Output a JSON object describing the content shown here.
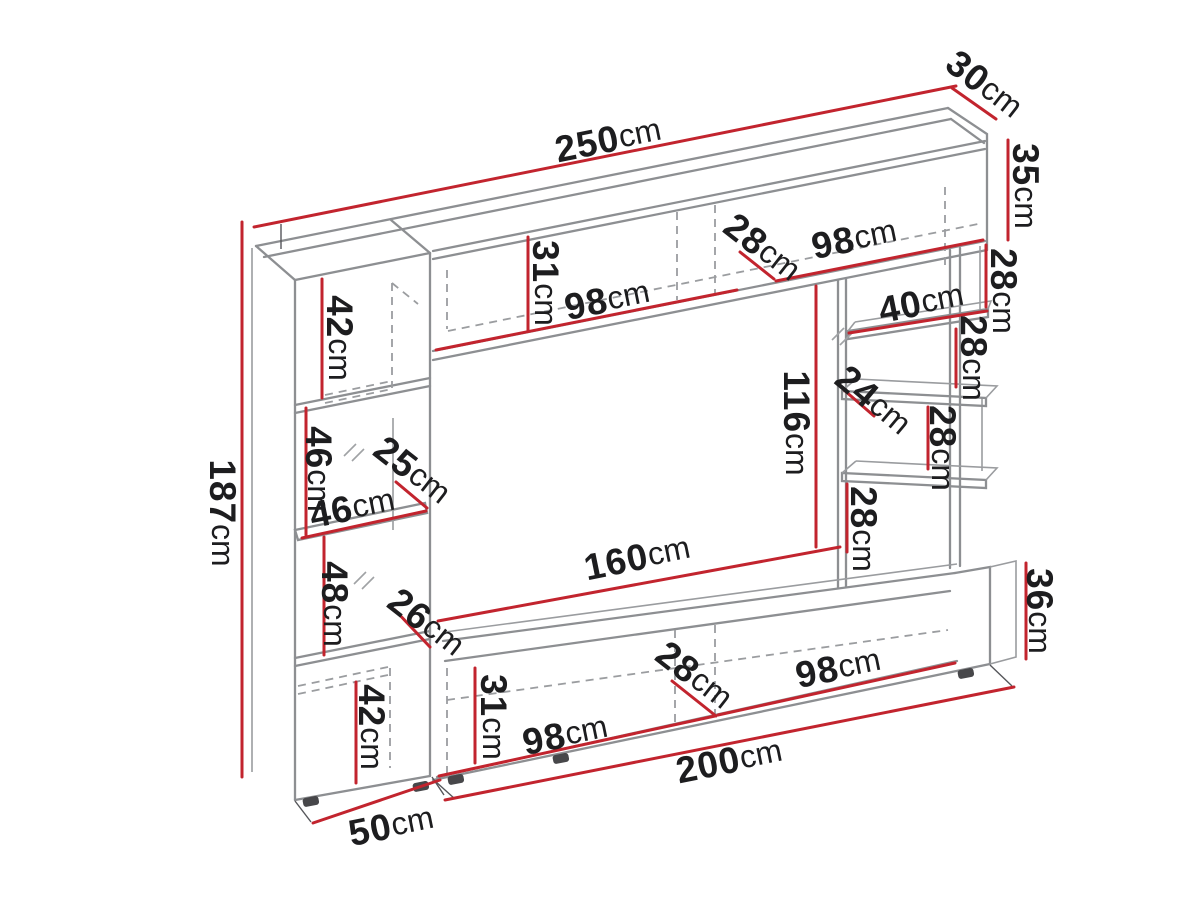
{
  "diagram": {
    "kind": "furniture-dimension-drawing",
    "unit_of_measure": "cm",
    "colors": {
      "dimension_line": "#c2242e",
      "outline": "#8d8f92",
      "hidden_edge": "#9b9da0",
      "label_text": "#1d1d1f",
      "background": "#ffffff"
    }
  },
  "labels": [
    {
      "name": "total-width",
      "value": "250",
      "unit": "cm",
      "text": "250cm"
    },
    {
      "name": "top-cabinet-depth",
      "value": "30",
      "unit": "cm",
      "text": "30cm"
    },
    {
      "name": "top-cabinet-height",
      "value": "35",
      "unit": "cm",
      "text": "35cm"
    },
    {
      "name": "unit-height",
      "value": "187",
      "unit": "cm",
      "text": "187cm"
    },
    {
      "name": "left-top-section-height",
      "value": "42",
      "unit": "cm",
      "text": "42cm"
    },
    {
      "name": "top-cabinet-interior-height",
      "value": "31",
      "unit": "cm",
      "text": "31cm"
    },
    {
      "name": "top-left-compartment-width",
      "value": "98",
      "unit": "cm",
      "text": "98cm"
    },
    {
      "name": "top-middle-compartment-width",
      "value": "28",
      "unit": "cm",
      "text": "28cm"
    },
    {
      "name": "top-right-compartment-width",
      "value": "98",
      "unit": "cm",
      "text": "98cm"
    },
    {
      "name": "right-gap-1-height",
      "value": "28",
      "unit": "cm",
      "text": "28cm"
    },
    {
      "name": "right-shelf-width",
      "value": "40",
      "unit": "cm",
      "text": "40cm"
    },
    {
      "name": "right-gap-2-height",
      "value": "28",
      "unit": "cm",
      "text": "28cm"
    },
    {
      "name": "right-shelf-depth",
      "value": "24",
      "unit": "cm",
      "text": "24cm"
    },
    {
      "name": "right-gap-3-height",
      "value": "28",
      "unit": "cm",
      "text": "28cm"
    },
    {
      "name": "right-gap-4-height",
      "value": "28",
      "unit": "cm",
      "text": "28cm"
    },
    {
      "name": "tv-niche-height",
      "value": "116",
      "unit": "cm",
      "text": "116cm"
    },
    {
      "name": "tv-niche-width",
      "value": "160",
      "unit": "cm",
      "text": "160cm"
    },
    {
      "name": "left-glass-section-height",
      "value": "46",
      "unit": "cm",
      "text": "46cm"
    },
    {
      "name": "left-niche-depth",
      "value": "25",
      "unit": "cm",
      "text": "25cm"
    },
    {
      "name": "left-niche-width",
      "value": "46",
      "unit": "cm",
      "text": "46cm"
    },
    {
      "name": "left-lower-glass-section-height",
      "value": "48",
      "unit": "cm",
      "text": "48cm"
    },
    {
      "name": "left-lower-niche-depth",
      "value": "26",
      "unit": "cm",
      "text": "26cm"
    },
    {
      "name": "left-bottom-section-height",
      "value": "42",
      "unit": "cm",
      "text": "42cm"
    },
    {
      "name": "bottom-cabinet-interior-height",
      "value": "31",
      "unit": "cm",
      "text": "31cm"
    },
    {
      "name": "bottom-left-compartment-width",
      "value": "98",
      "unit": "cm",
      "text": "98cm"
    },
    {
      "name": "bottom-middle-compartment-width",
      "value": "28",
      "unit": "cm",
      "text": "28cm"
    },
    {
      "name": "bottom-right-compartment-width",
      "value": "98",
      "unit": "cm",
      "text": "98cm"
    },
    {
      "name": "bottom-cabinet-height",
      "value": "36",
      "unit": "cm",
      "text": "36cm"
    },
    {
      "name": "bottom-cabinet-width",
      "value": "200",
      "unit": "cm",
      "text": "200cm"
    },
    {
      "name": "left-column-width",
      "value": "50",
      "unit": "cm",
      "text": "50cm"
    }
  ]
}
